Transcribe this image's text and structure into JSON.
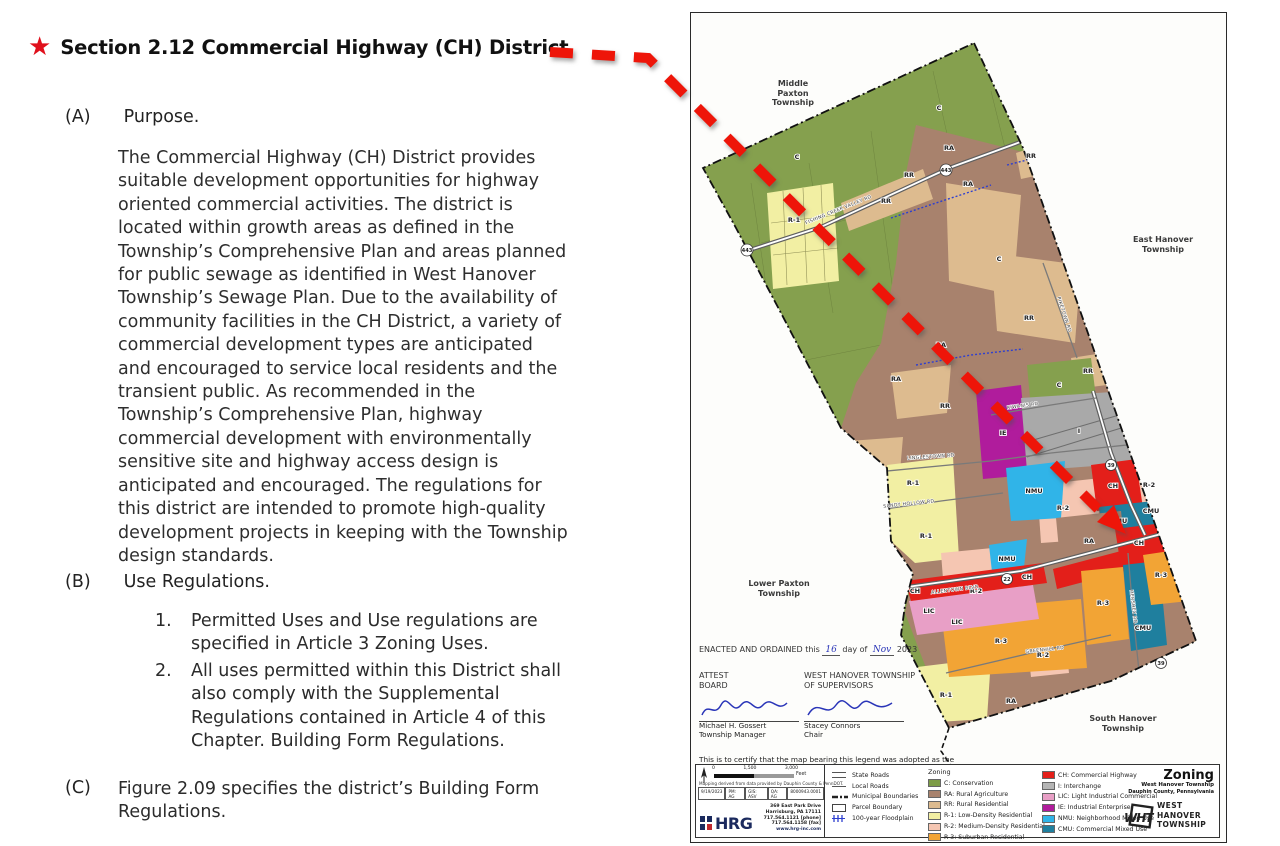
{
  "doc": {
    "heading": "Section 2.12 Commercial Highway (CH) District",
    "a_label": "(A)",
    "a_title": "Purpose.",
    "a_body": "The Commercial Highway (CH) District provides suitable development opportunities for highway oriented commercial activities. The district is located within growth areas as defined in the Township’s Comprehensive Plan and areas planned for public sewage as identified in West Hanover Township’s Sewage Plan. Due to the availability of community facilities in the CH District, a variety of commercial development types are anticipated and encouraged to service local residents and the transient public. As recommended in the Township’s Comprehensive Plan, highway commercial development with environmentally sensitive site and highway access design is anticipated and encouraged. The regulations for this district are intended to promote high-quality development projects in keeping with the Township design standards.",
    "b_label": "(B)",
    "b_title": "Use Regulations.",
    "b_items": [
      {
        "num": "1.",
        "text": "Permitted Uses and Use regulations are specified in Article 3 Zoning Uses."
      },
      {
        "num": "2.",
        "text": "All uses permitted within this District shall also comply with the Supplemental Regulations contained in Article 4 of this Chapter. Building Form Regulations."
      }
    ],
    "c_label": "(C)",
    "c_text": "Figure 2.09 specifies the district’s Building Form Regulations."
  },
  "map": {
    "codes": {
      "c": "C",
      "ra": "RA",
      "rr": "RR",
      "r1": "R-1",
      "r2": "R-2",
      "r3": "R-3",
      "ch": "CH",
      "i": "I",
      "lic": "LIC",
      "ie": "IE",
      "nmu": "NMU",
      "cmu": "CMU"
    },
    "roads": {
      "fishing": "FISHING CREEK VALLEY RD",
      "linglestown": "LINGLESTOWN RD",
      "sandy": "SANDY HOLLOW RD",
      "kiwanis": "KIWANIS RD",
      "piketown": "PIKETOWN RD",
      "allentown": "ALLENTOWN BLVD",
      "greenhill": "GREENHILL RD",
      "hershey": "HERSHEY RD"
    },
    "shields": {
      "s443": "443",
      "s39": "39",
      "s22": "22"
    },
    "neighbors": {
      "mp": [
        "Middle",
        "Paxton",
        "Township"
      ],
      "eh": [
        "East Hanover",
        "Township"
      ],
      "lp": [
        "Lower Paxton",
        "Township"
      ],
      "sh": [
        "South Hanover",
        "Township"
      ]
    },
    "enacted": {
      "prefix": "ENACTED AND ORDAINED this",
      "day": "16",
      "mid": "day of",
      "month": "Nov",
      "year": "2023"
    },
    "attest": [
      "ATTEST",
      "BOARD"
    ],
    "supervisors": [
      "WEST HANOVER TOWNSHIP",
      "OF SUPERVISORS"
    ],
    "signatures": [
      {
        "name": "Michael H. Gossert",
        "title": "Township Manager"
      },
      {
        "name": "Stacey Connors",
        "title": "Chair"
      }
    ],
    "cert": {
      "line1": "This is to certify that the map bearing this legend was adopted as the",
      "line2": "official Zoning Map of the Township by enactment of the Zoning",
      "line3": "Ordinance of West Hanover Township, Dauphin County, Pennsylvania",
      "line4a": "under Ordinance No.",
      "no": "07",
      "line4b": "-2023"
    },
    "scale": {
      "ticks": [
        "0",
        "1,500",
        "3,000"
      ],
      "unit": "Feet",
      "note": "Mapping derived from data provided by Dauphin County & PennDOT."
    },
    "stamp_cells": [
      "9/19/2023",
      "PM: AG",
      "GIS: ASV",
      "QA: AG",
      "8000943.0001"
    ],
    "hrg": {
      "name": "HRG",
      "address": [
        "369 East Park Drive",
        "Harrisburg, PA 17111",
        "717.564.1121 [phone]",
        "717.564.1158 [fax]",
        "www.hrg-inc.com"
      ]
    },
    "legend": {
      "line_items": [
        "State Roads",
        "Local Roads",
        "Municipal Boundaries",
        "Parcel Boundary",
        "100-year Floodplain"
      ],
      "zoning_title": "Zoning",
      "zones": [
        {
          "label": "C: Conservation",
          "color": "#7d9c47"
        },
        {
          "label": "RA: Rural Agriculture",
          "color": "#a8826d"
        },
        {
          "label": "RR: Rural Residential",
          "color": "#ddbb8f"
        },
        {
          "label": "R-1: Low-Density Residential",
          "color": "#f2efa3"
        },
        {
          "label": "R-2: Medium-Density Residential",
          "color": "#f5c6b2"
        },
        {
          "label": "R-3: Suburban Residential",
          "color": "#f2a435"
        },
        {
          "label": "CH: Commercial Highway",
          "color": "#e31f1a"
        },
        {
          "label": "I: Interchange",
          "color": "#b5b5b5"
        },
        {
          "label": "LIC: Light Industrial Commercial",
          "color": "#e89fc6"
        },
        {
          "label": "IE: Industrial Enterprise",
          "color": "#b01c9c"
        },
        {
          "label": "NMU: Neighborhood Mixed Use",
          "color": "#30b4e8"
        },
        {
          "label": "CMU: Commercial Mixed Use",
          "color": "#1f7f9e"
        }
      ]
    },
    "titleblock": {
      "title": "Zoning",
      "line1": "West Hanover Township",
      "line2": "Dauphin County, Pennsylvania"
    },
    "wht_logo": {
      "initials": "WHT",
      "words": [
        "WEST",
        "HANOVER",
        "TOWNSHIP"
      ]
    }
  },
  "accent": {
    "star_red": "#e0101c",
    "arrow_red": "#ee1509"
  }
}
